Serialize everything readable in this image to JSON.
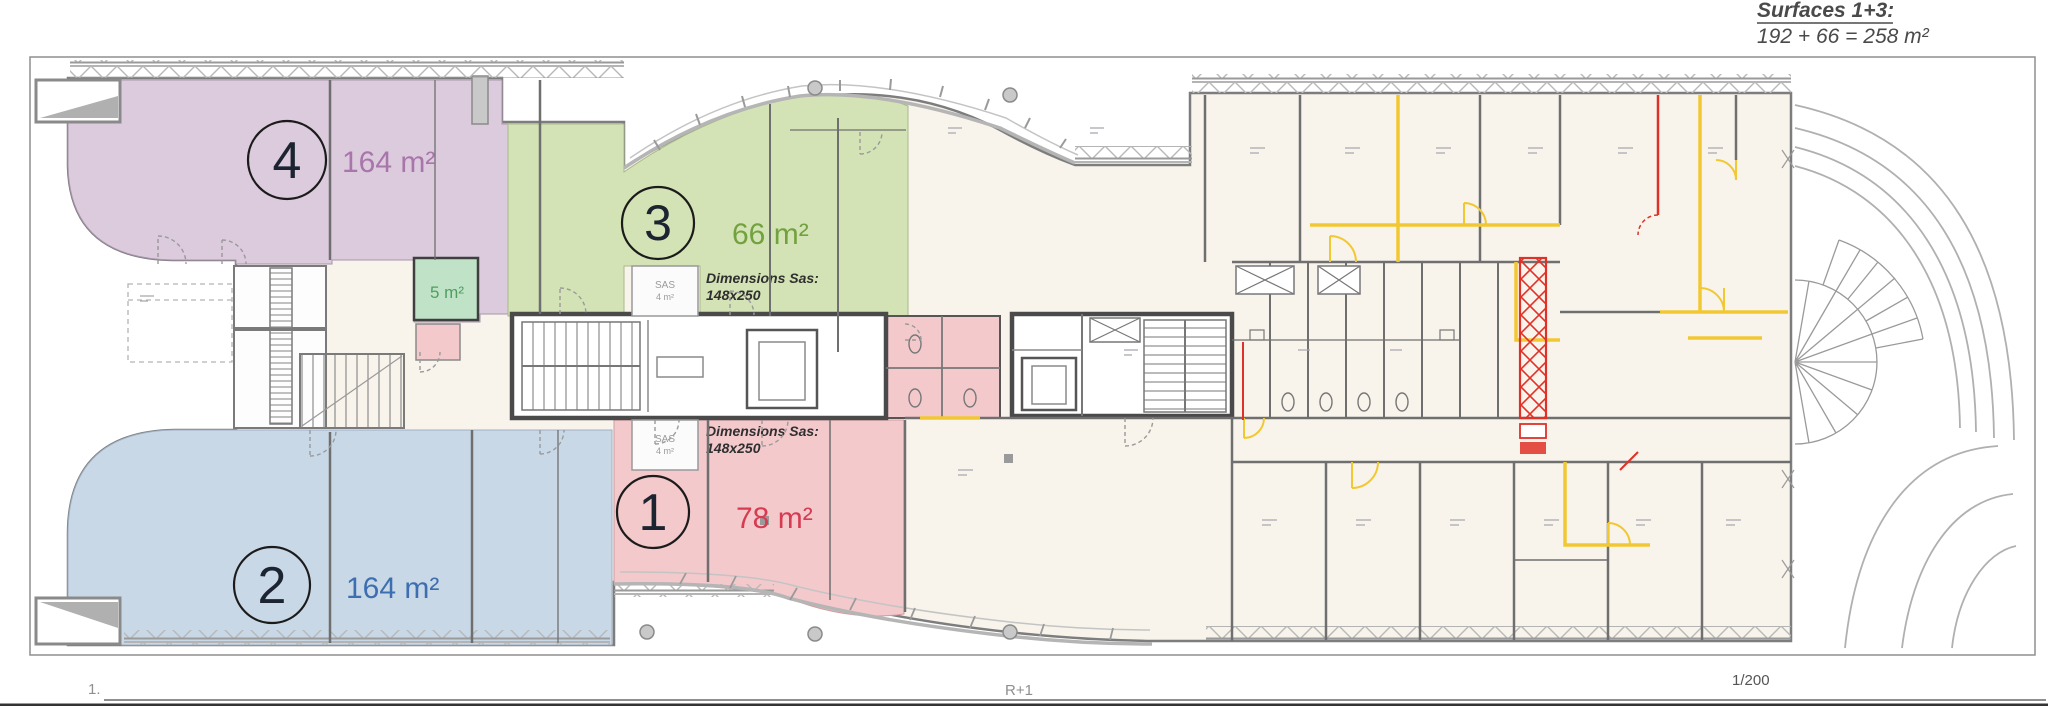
{
  "header": {
    "title": "Surfaces 1+3:",
    "formula": "192 + 66 = 258 m²"
  },
  "zones": {
    "zone1": {
      "number": "1",
      "area": "78 m²",
      "fill": "#f3c9cc",
      "label_color": "#d63b52"
    },
    "zone2": {
      "number": "2",
      "area": "164 m²",
      "fill": "#c9d8e7",
      "label_color": "#3d6fb0"
    },
    "zone3": {
      "number": "3",
      "area": "66 m²",
      "fill": "#d4e3b5",
      "label_color": "#71a23f"
    },
    "zone4": {
      "number": "4",
      "area": "164 m²",
      "fill": "#dccadd",
      "label_color": "#a876aa"
    },
    "closet": {
      "area": "5 m²",
      "fill": "#c0e3c8",
      "label_color": "#4f9e5f"
    }
  },
  "sas": {
    "label": "SAS",
    "area": "4 m²",
    "note_title": "Dimensions Sas:",
    "note_value": "148x250"
  },
  "footer": {
    "sheet": "1.",
    "level": "R+1",
    "scale": "1/200"
  },
  "palette": {
    "wall": "#6f6f6f",
    "facade": "#b5b5b5",
    "accent_yellow": "#f2c832",
    "accent_red": "#e03128",
    "paper": "#f8f4eb"
  }
}
